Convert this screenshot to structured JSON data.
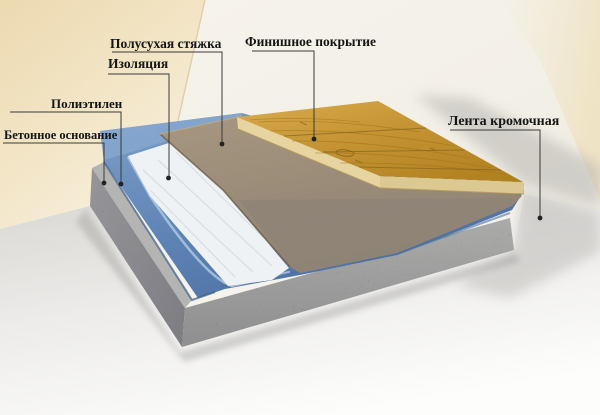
{
  "diagram": {
    "type": "floor-construction-cutaway",
    "labels": {
      "semi_dry_screed": "Полусухая стяжка",
      "insulation": "Изоляция",
      "polyethylene": "Полиэтилен",
      "concrete_base": "Бетонное основание",
      "finish_coating": "Финишное покрытие",
      "edge_tape": "Лента кромочная"
    },
    "layers_bottom_to_top": [
      "Бетонное основание",
      "Полиэтилен",
      "Изоляция",
      "Полусухая стяжка",
      "Финишное покрытие"
    ],
    "colors": {
      "wall_left_beige": "#eedcb6",
      "wall_right": "#f4f1e8",
      "floor": "#f1f1ef",
      "concrete_gray": "#9b9b99",
      "concrete_dark": "#84848a",
      "ledge_gray": "#b4b4b2",
      "film_blue": "#5d83b4",
      "film_blue_dark": "#3f6394",
      "film_blue_light": "#8fadd2",
      "insulation_white": "#eff2f5",
      "screed_brown_top": "#9c8c76",
      "screed_face": "#95897b",
      "wood_gold": "#c59434",
      "wood_grain_dark": "#8d6414",
      "wood_edge_light": "#e7d5a1",
      "leader_line": "#3a3a3a",
      "label_text": "#151515"
    }
  }
}
